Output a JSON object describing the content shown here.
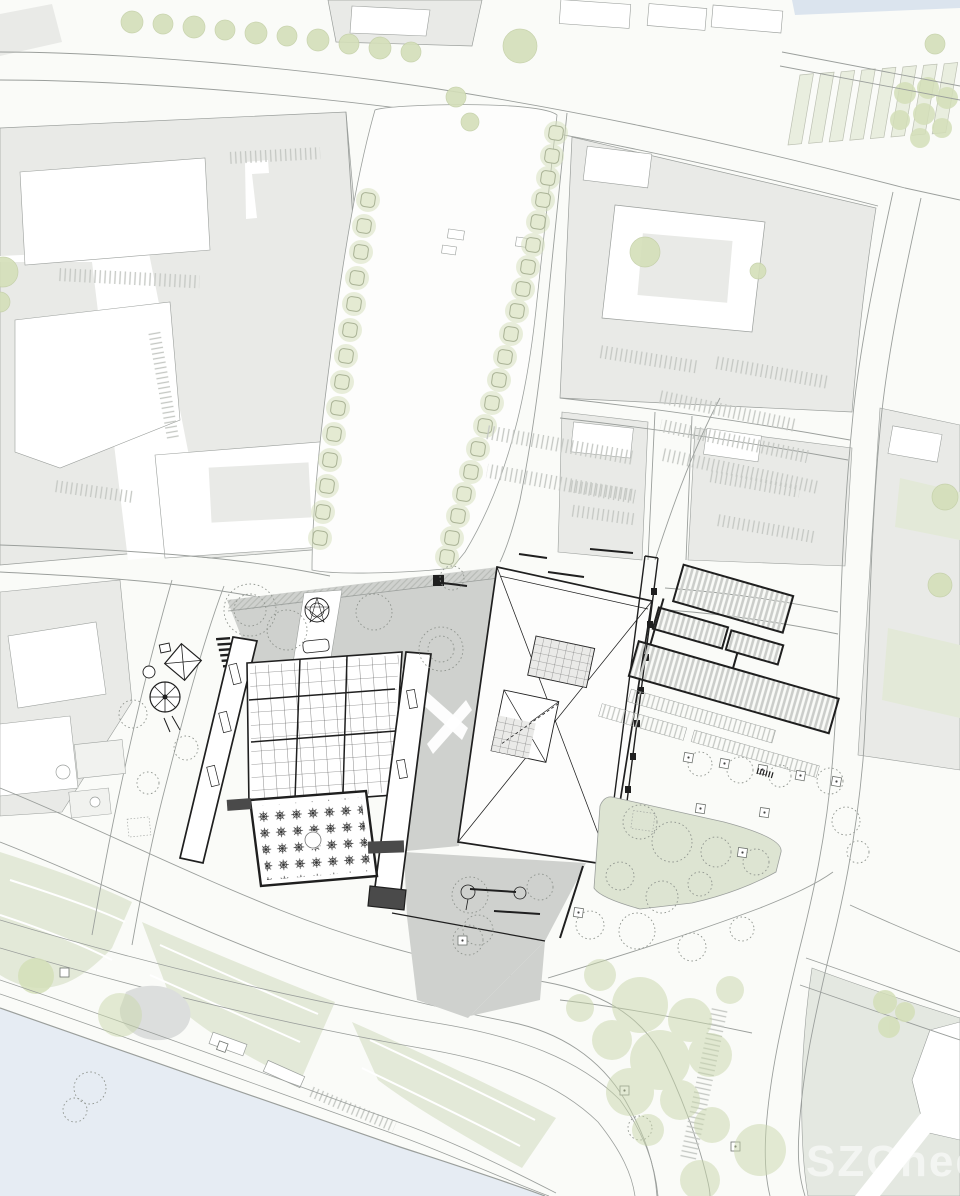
{
  "watermark": {
    "text": "SZCheesy"
  },
  "colors": {
    "bg": "#fafbf8",
    "block": "#e9eae7",
    "block2": "#e4e8e1",
    "plaza": "#cfd1ce",
    "water": "#e6ecf3",
    "lawn": "#dde4d2",
    "lawn2": "#e3e9d8",
    "sage": "#d4dfb9",
    "soft": "#c9d7ab",
    "allot": "#e9eedf",
    "curb": "#9b9f9c",
    "ink": "#1f1f1f",
    "stipple": "#8f948e",
    "blob": "#dcdedd",
    "blue": "#dbe4ee"
  },
  "features": {
    "water_body": "river",
    "esplanade": "central esplanade park",
    "grid_hall": "gridded-roof hall with courtyard",
    "exhibition_hall": "large hall with hipped roof and skylights",
    "east_wings": "hatched-roof building wings",
    "lawn": "public lawn",
    "waterfront_park": "waterfront tree park",
    "allotments": "garden strips",
    "city_blocks": "surrounding city blocks"
  }
}
